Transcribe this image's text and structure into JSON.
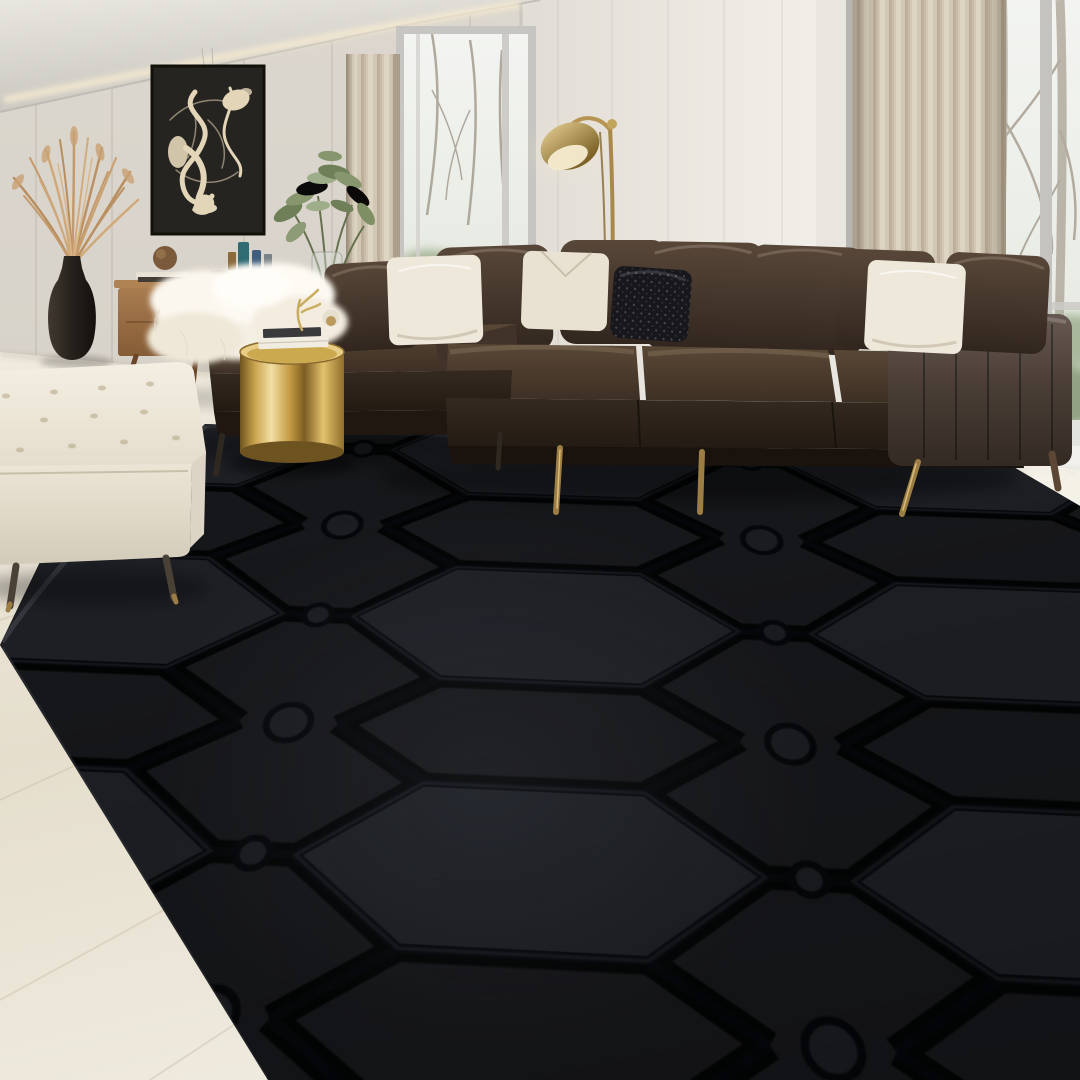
{
  "image": {
    "type": "photograph",
    "subject": "Modern living room staged with a large black embossed geometric area rug",
    "width_px": 1080,
    "height_px": 1080,
    "text_visible": "none"
  },
  "palette": {
    "wall-left": "#d8d3ca",
    "wall-right": "#eeebe5",
    "ceiling": "#dfdcd5",
    "cove-glow": "#f6ead0",
    "floor-wood": "#eae3d3",
    "curtain": "#d1c6b3",
    "window-sky": "#f2f3f0",
    "window-foliage": "#9cab8c",
    "window-frame": "#bdbcb8",
    "art-canvas": "#262420",
    "art-stroke": "#e3d6b8",
    "sideboard-wood": "#9b6f46",
    "vase-dark": "#241f1a",
    "pampas": "#c49a6d",
    "plant-green": "#6f7f58",
    "lamp-brass": "#b59551",
    "sofa-leather": "#3b2f26",
    "sofa-leather-light": "#5f4f42",
    "sofa-leather-dark": "#241c15",
    "pillow-white": "#eee8da",
    "pillow-sequin": "#17171c",
    "sheepskin": "#f9f5ec",
    "gold-table": "#c9a54e",
    "ottoman": "#f0eade",
    "rug-black": "#17181b",
    "rug-groove": "#05070a",
    "rug-facet": "#1e2025",
    "leg-brass": "#9c7d43",
    "leg-wood": "#5c4734"
  },
  "scene": {
    "room": "living room with floor-to-ceiling windows, bare winter trees outside",
    "objects": [
      {
        "label": "abstract expressionist wall art, cream strokes on dark canvas",
        "color": "#262420"
      },
      {
        "label": "tall dark ceramic floor vase with dried pampas grass",
        "color": "#241f1a"
      },
      {
        "label": "mid-century walnut sideboard with books, sphere and glass bottles",
        "color": "#9b6f46"
      },
      {
        "label": "leafy green plant in glass vase",
        "color": "#6f7f58"
      },
      {
        "label": "brass dome floor lamp",
        "color": "#b59551"
      },
      {
        "label": "beige pleated floor-to-ceiling curtains",
        "color": "#d1c6b3"
      },
      {
        "label": "dark espresso leather L-shaped sectional sofa with brass legs",
        "color": "#3b2f26"
      },
      {
        "label": "white throw pillows",
        "color": "#eee8da"
      },
      {
        "label": "black sequin accent pillow",
        "color": "#17171c"
      },
      {
        "label": "white sheepskin throw on chaise",
        "color": "#f9f5ec"
      },
      {
        "label": "brushed gold drum side table with stacked books and brass decor",
        "color": "#c9a54e"
      },
      {
        "label": "white tufted leather ottoman",
        "color": "#f0eade"
      },
      {
        "label": "black plush area rug with embossed hexagon lattice pattern",
        "color": "#17181b"
      },
      {
        "label": "light oak plank floor",
        "color": "#eae3d3"
      }
    ]
  }
}
